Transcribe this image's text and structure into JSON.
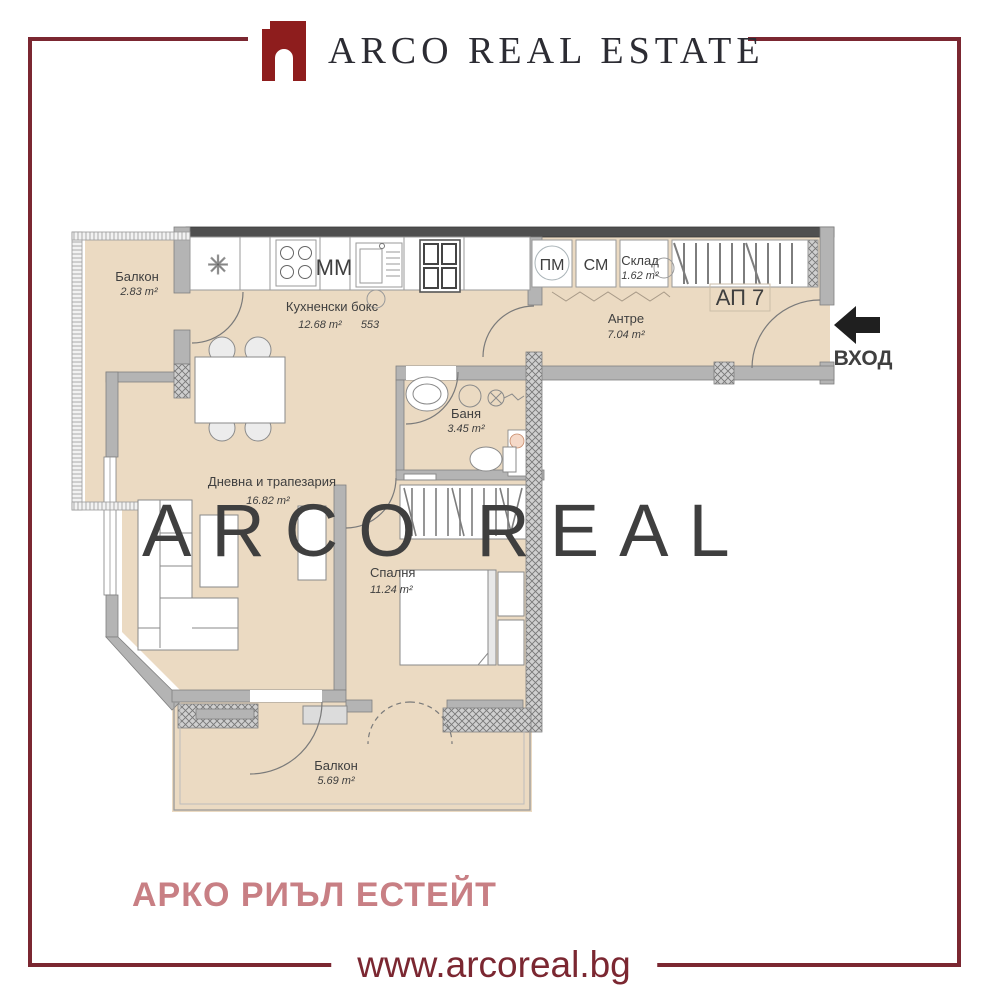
{
  "page": {
    "border_color": "#7b2731",
    "background": "#ffffff"
  },
  "header": {
    "brand": "ARCO REAL ESTATE",
    "logo_color": "#8e1d1d"
  },
  "watermark": "ARCO REAL",
  "floorplan": {
    "apartment_label": "АП 7",
    "entrance_label": "ВХОД",
    "rooms": {
      "balcony_top": {
        "name": "Балкон",
        "area": "2.83 m²"
      },
      "kitchen": {
        "name": "Кухненски бокс",
        "area": "12.68 m²",
        "note": "553"
      },
      "storage": {
        "name": "Склад",
        "area": "1.62 m²"
      },
      "hall": {
        "name": "Антре",
        "area": "7.04 m²"
      },
      "bath": {
        "name": "Баня",
        "area": "3.45 m²"
      },
      "living": {
        "name": "Дневна и трапезария",
        "area": "16.82 m²"
      },
      "bedroom": {
        "name": "Спалня",
        "area": "11.24 m²"
      },
      "balcony_bottom": {
        "name": "Балкон",
        "area": "5.69 m²"
      }
    },
    "appliances": {
      "pm": "ПМ",
      "sm": "СМ",
      "mm": "ММ"
    },
    "colors": {
      "floor": "#ebdac2",
      "wall": "#b4b4b4",
      "wall_dark": "#4f4f4f"
    }
  },
  "footer": {
    "brand_localized": "АРКО РИЪЛ ЕСТЕЙТ",
    "website": "www.arcoreal.bg"
  }
}
